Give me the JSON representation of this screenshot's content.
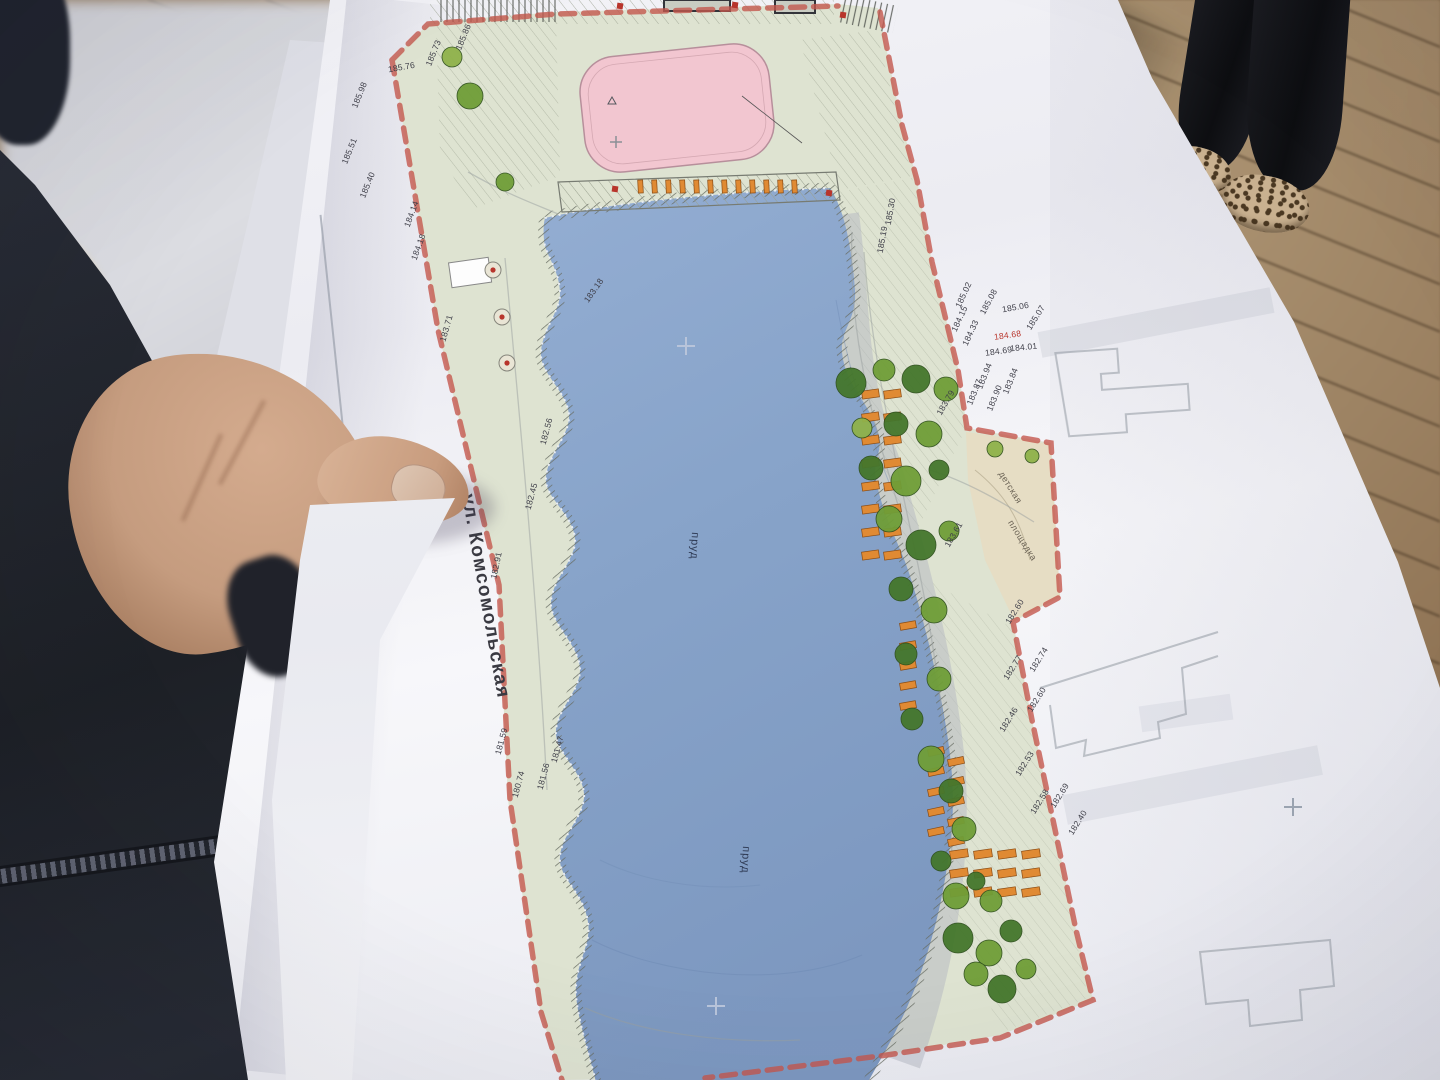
{
  "palette": {
    "paper": "#f2f2f6",
    "pond_blue": "#87a3c9",
    "site_green": "#dee3d1",
    "rink_pink": "#f2c6d0",
    "boundary_red": "#c4584e",
    "bench_orange": "#e08a33",
    "tree_dark": "#44762c",
    "tree_mid": "#6f9d37",
    "tree_light": "#8fb24a",
    "playground_beige": "#e6dcc2",
    "deck_wood": "#9a7e5c",
    "jacket_navy": "#23262e",
    "skin": "#c9a186",
    "red_note": "#b8352c"
  },
  "plan": {
    "street_label": "ул. Комсомольская",
    "pond_labels": [
      "пруд",
      "пруд"
    ],
    "playground_labels": [
      "детская",
      "площадка"
    ],
    "elevations": [
      {
        "v": "185.98",
        "x": 362,
        "y": 96,
        "r": -68
      },
      {
        "v": "185.76",
        "x": 402,
        "y": 70,
        "r": -10
      },
      {
        "v": "185.73",
        "x": 436,
        "y": 54,
        "r": -68
      },
      {
        "v": "185.51",
        "x": 352,
        "y": 152,
        "r": -68
      },
      {
        "v": "185.40",
        "x": 370,
        "y": 186,
        "r": -68
      },
      {
        "v": "185.86",
        "x": 466,
        "y": 38,
        "r": -68
      },
      {
        "v": "184.14",
        "x": 414,
        "y": 215,
        "r": -70
      },
      {
        "v": "184.18",
        "x": 421,
        "y": 248,
        "r": -70
      },
      {
        "v": "183.71",
        "x": 449,
        "y": 329,
        "r": -74
      },
      {
        "v": "182.91",
        "x": 499,
        "y": 566,
        "r": -78
      },
      {
        "v": "183.18",
        "x": 596,
        "y": 292,
        "r": -55
      },
      {
        "v": "182.56",
        "x": 549,
        "y": 432,
        "r": -75
      },
      {
        "v": "182.45",
        "x": 534,
        "y": 497,
        "r": -75
      },
      {
        "v": "181.59",
        "x": 504,
        "y": 742,
        "r": -75
      },
      {
        "v": "180.74",
        "x": 521,
        "y": 785,
        "r": -75
      },
      {
        "v": "181.56",
        "x": 546,
        "y": 777,
        "r": -75
      },
      {
        "v": "181.47",
        "x": 560,
        "y": 750,
        "r": -75
      },
      {
        "v": "185.30",
        "x": 893,
        "y": 212,
        "r": -80
      },
      {
        "v": "185.19",
        "x": 885,
        "y": 240,
        "r": -80
      },
      {
        "v": "185.02",
        "x": 966,
        "y": 296,
        "r": -65
      },
      {
        "v": "185.08",
        "x": 991,
        "y": 303,
        "r": -62
      },
      {
        "v": "185.06",
        "x": 1016,
        "y": 310,
        "r": -10
      },
      {
        "v": "185.07",
        "x": 1038,
        "y": 319,
        "r": -58
      },
      {
        "v": "184.15",
        "x": 962,
        "y": 320,
        "r": -65
      },
      {
        "v": "184.33",
        "x": 973,
        "y": 334,
        "r": -65
      },
      {
        "v": "184.68",
        "x": 1008,
        "y": 338,
        "r": -8,
        "red": true
      },
      {
        "v": "184.69",
        "x": 999,
        "y": 354,
        "r": -8
      },
      {
        "v": "184.01",
        "x": 1024,
        "y": 350,
        "r": -6
      },
      {
        "v": "183.94",
        "x": 987,
        "y": 377,
        "r": -68
      },
      {
        "v": "183.90",
        "x": 997,
        "y": 399,
        "r": -68
      },
      {
        "v": "183.87",
        "x": 977,
        "y": 393,
        "r": -68
      },
      {
        "v": "183.84",
        "x": 1013,
        "y": 382,
        "r": -68
      },
      {
        "v": "183.79",
        "x": 948,
        "y": 404,
        "r": -60
      },
      {
        "v": "183.61",
        "x": 956,
        "y": 536,
        "r": -60
      },
      {
        "v": "182.60",
        "x": 1017,
        "y": 613,
        "r": -58
      },
      {
        "v": "182.74",
        "x": 1041,
        "y": 661,
        "r": -58
      },
      {
        "v": "182.77",
        "x": 1015,
        "y": 669,
        "r": -58
      },
      {
        "v": "182.60",
        "x": 1039,
        "y": 701,
        "r": -58
      },
      {
        "v": "182.46",
        "x": 1011,
        "y": 721,
        "r": -58
      },
      {
        "v": "182.53",
        "x": 1027,
        "y": 765,
        "r": -58
      },
      {
        "v": "182.58",
        "x": 1042,
        "y": 803,
        "r": -58
      },
      {
        "v": "182.69",
        "x": 1062,
        "y": 797,
        "r": -58
      },
      {
        "v": "182.40",
        "x": 1080,
        "y": 824,
        "r": -58
      }
    ]
  }
}
